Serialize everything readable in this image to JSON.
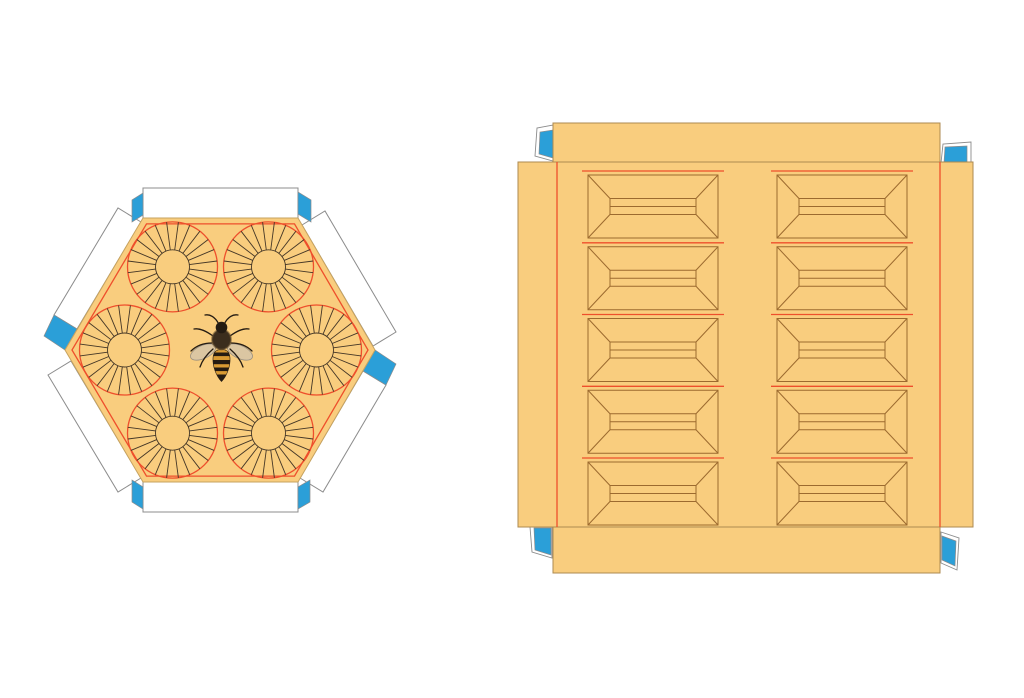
{
  "canvas": {
    "width": 1024,
    "height": 698,
    "background": "#ffffff"
  },
  "palette": {
    "amber": "#f9cd7e",
    "fold_red": "#ee4f2c",
    "line_dark": "#443626",
    "frame_brown": "#9c6a2f",
    "cut_gray": "#8c8c8c",
    "cut_tan": "#ad8a50",
    "hex_edge": "#c7a35f",
    "tab_blue": "#2b9fd8",
    "flap_white": "#ffffff",
    "bee_dark": "#241b12",
    "bee_thorax": "#3b2d1d",
    "bee_fuzz": "#6a5130",
    "bee_amber": "#d89a33",
    "wing_fill": "rgba(190,192,198,0.5)",
    "wing_stroke": "rgba(110,112,120,0.65)"
  },
  "hex_lid": {
    "name": "hexagonal-lid-template",
    "description": "Hexagonal honeycomb lid die-cut: amber hexagon, inner red fold hexagon, six sunburst rosettes, honeybee photo at center, six white glue flaps, six blue tuck tabs",
    "rosettes": {
      "count": 6,
      "spokes": 24,
      "ring_radius": 96,
      "outer_radius": 45,
      "inner_radius": 17,
      "spoke_angle_offset_deg": 7.5,
      "center": {
        "x": 220.5,
        "y": 350
      }
    },
    "flap_count": 6,
    "blue_tab_count": 6
  },
  "box_body": {
    "name": "square-box-template",
    "description": "Square box die-cut: amber panel with left/right side flaps, top and bottom glue flaps, four blue tuck tabs, and two columns of five beveled hive-frame panels",
    "frames": {
      "columns": 2,
      "rows": 5,
      "column_x": [
        588,
        777
      ],
      "row_y": [
        175,
        246.75,
        318.5,
        390.25,
        462
      ],
      "separator_y": [
        171,
        242.8,
        314.5,
        386.3,
        458
      ],
      "width": 130,
      "height": 63,
      "band_inset": 22,
      "band_height": 16
    },
    "fold_x": [
      557,
      940
    ],
    "blue_tab_count": 4
  },
  "bee": {
    "name": "honeybee-image",
    "kind": "top-view honeybee photo, wings spread, striped abdomen"
  }
}
